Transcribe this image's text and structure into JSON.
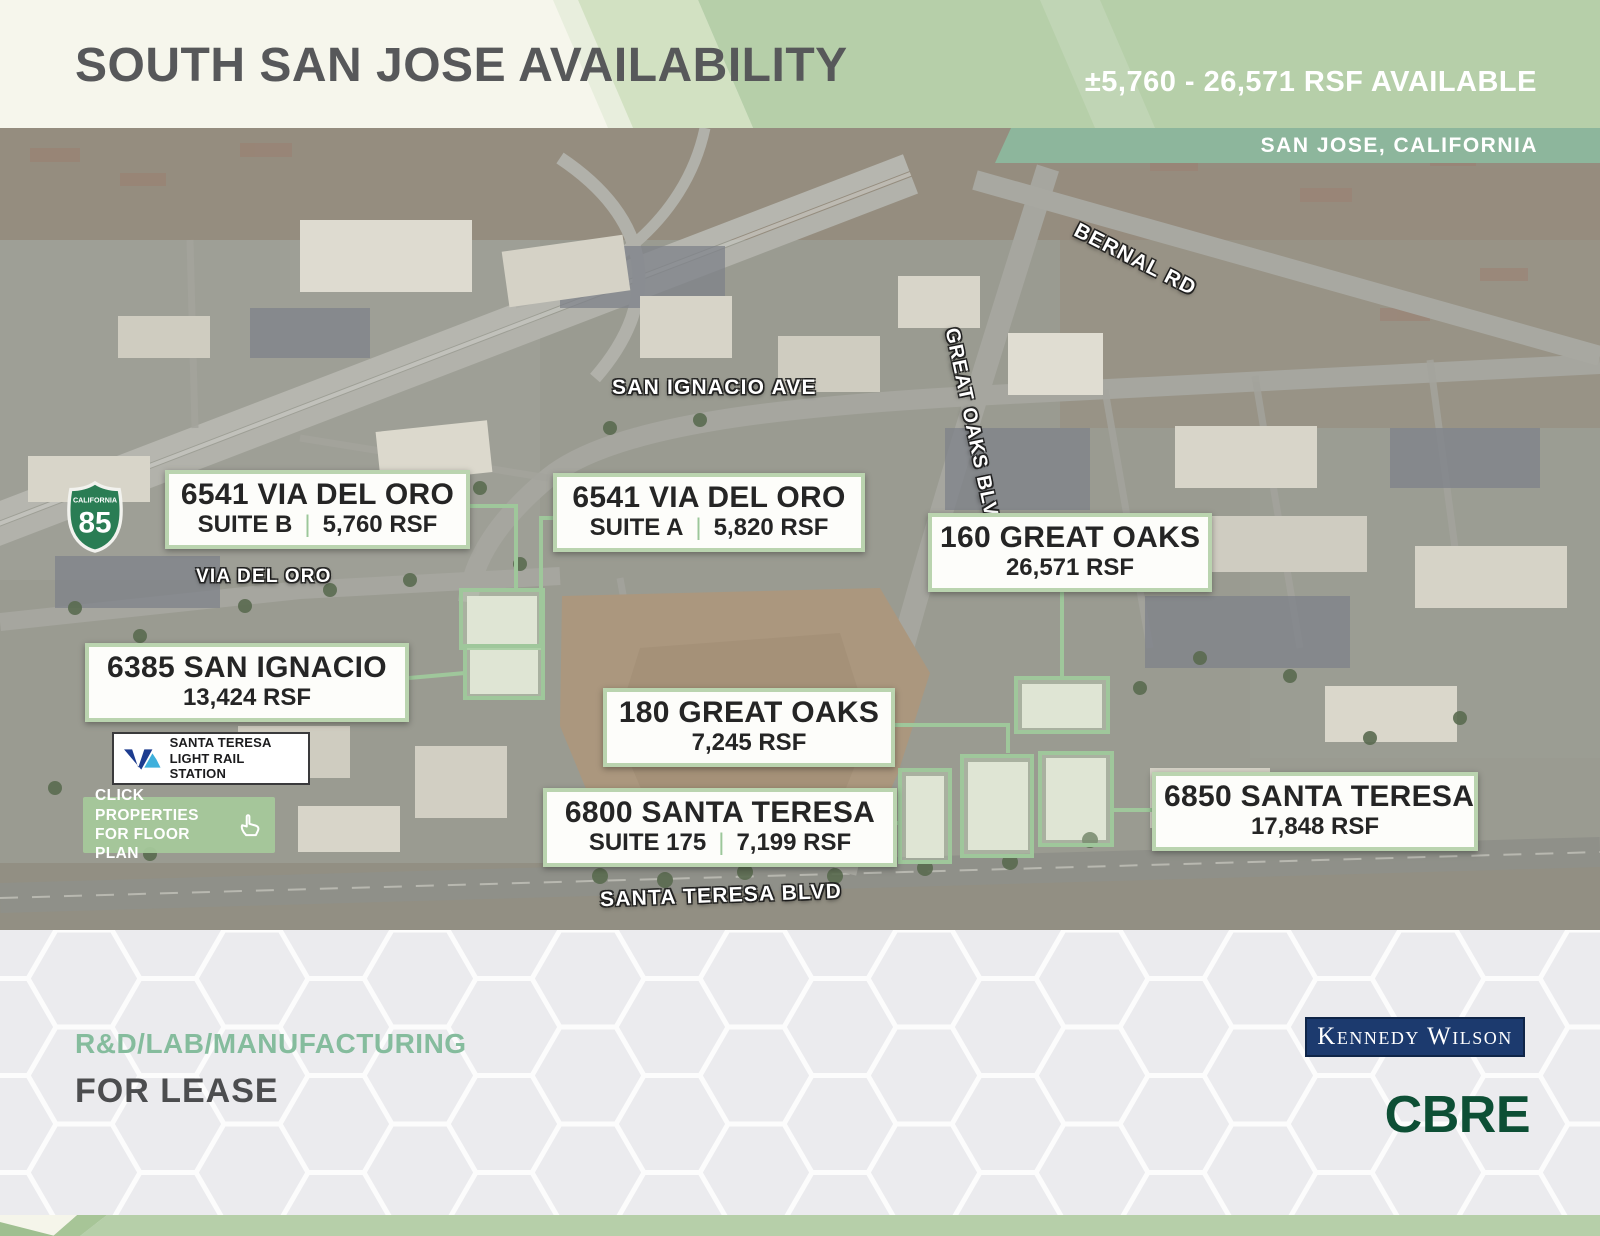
{
  "header": {
    "title": "SOUTH SAN JOSE AVAILABILITY",
    "availability": "±5,760 - 26,571 RSF AVAILABLE",
    "location": "SAN JOSE, CALIFORNIA"
  },
  "map": {
    "road_labels": {
      "bernal": "BERNAL RD",
      "san_ignacio": "SAN IGNACIO AVE",
      "great_oaks": "GREAT OAKS BLVD",
      "via_del_oro": "VIA DEL ORO",
      "santa_teresa": "SANTA TERESA BLVD"
    },
    "highway_shield": {
      "state": "CALIFORNIA",
      "number": "85"
    },
    "label_divider": "|",
    "properties": [
      {
        "name": "6541 VIA DEL ORO",
        "suite": "SUITE B",
        "rsf": "5,760 RSF"
      },
      {
        "name": "6541 VIA DEL ORO",
        "suite": "SUITE A",
        "rsf": "5,820 RSF"
      },
      {
        "name": "160 GREAT OAKS",
        "rsf": "26,571 RSF"
      },
      {
        "name": "6385 SAN IGNACIO",
        "rsf": "13,424 RSF"
      },
      {
        "name": "180 GREAT OAKS",
        "rsf": "7,245 RSF"
      },
      {
        "name": "6800 SANTA TERESA",
        "suite": "SUITE 175",
        "rsf": "7,199 RSF"
      },
      {
        "name": "6850 SANTA TERESA",
        "rsf": "17,848 RSF"
      }
    ],
    "transit": {
      "station_line1": "SANTA TERESA",
      "station_line2": "LIGHT RAIL STATION"
    },
    "cta": {
      "line1": "CLICK PROPERTIES",
      "line2": "FOR FLOOR PLAN"
    }
  },
  "footer": {
    "property_type": "R&D/LAB/MANUFACTURING",
    "lease_status": "FOR LEASE",
    "broker_primary": "Kennedy Wilson",
    "broker_secondary": "CBRE"
  },
  "colors": {
    "header_green": "#b6cfa9",
    "location_band_green": "#8db69c",
    "accent_green": "#9cc79a",
    "cbre_green": "#0d4f35",
    "kennedy_wilson_navy": "#1c3a6e"
  }
}
